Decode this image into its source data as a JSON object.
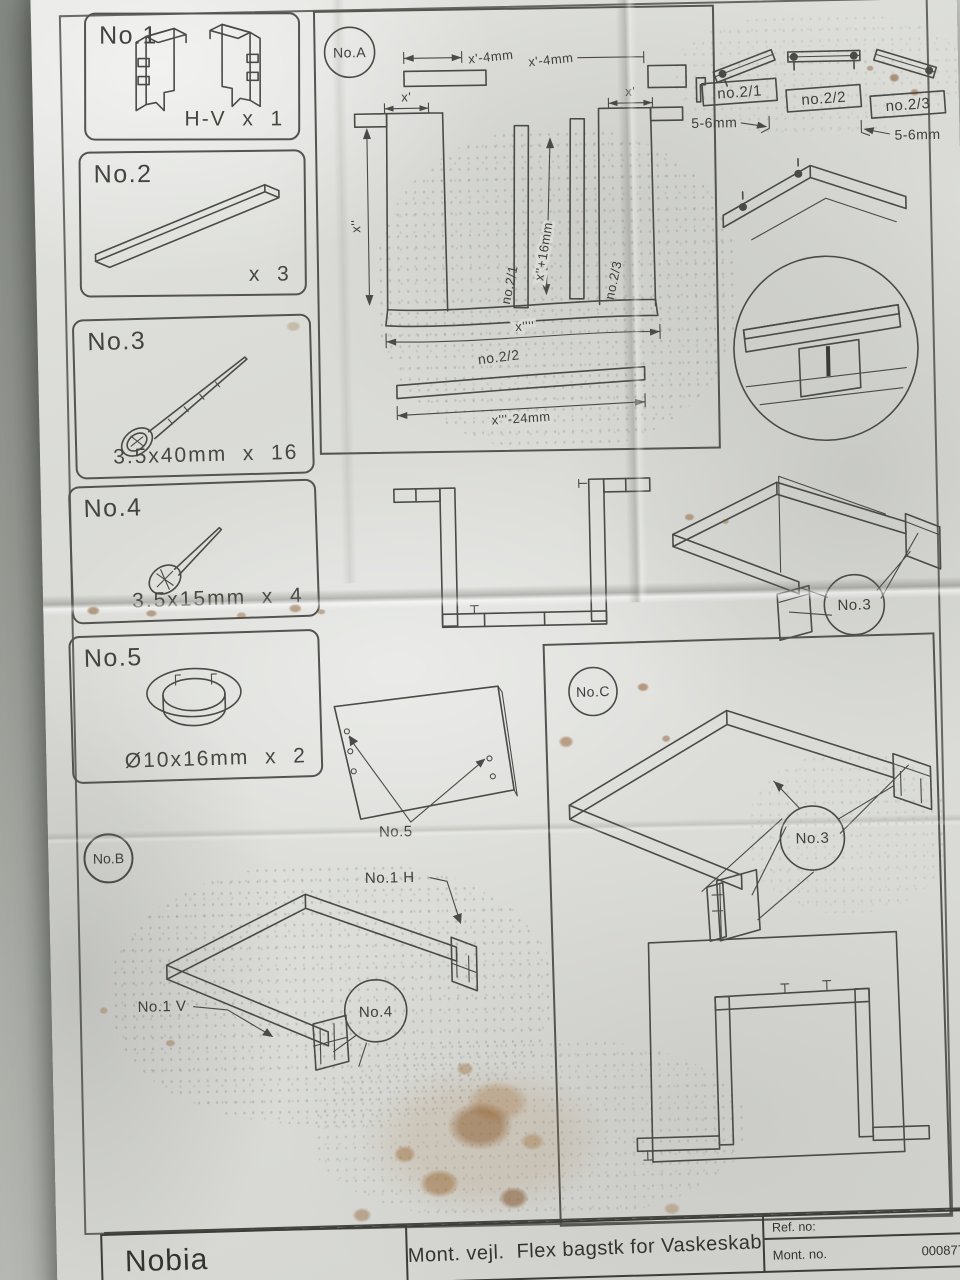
{
  "footer": {
    "brand": "Nobia",
    "title": "Mont. vejl.  Flex bagstk for Vaskeskab",
    "ref_label": "Ref. no:",
    "mont_label": "Mont. no.",
    "mont_value": "000877"
  },
  "parts": [
    {
      "label": "No.1",
      "qty": "H-V  x  1"
    },
    {
      "label": "No.2",
      "qty": "x  3"
    },
    {
      "label": "No.3",
      "qty": "3.5x40mm  x  16"
    },
    {
      "label": "No.4",
      "qty": "3.5x15mm  x  4"
    },
    {
      "label": "No.5",
      "qty": "Ø10x16mm  x  2"
    }
  ],
  "sectionA": {
    "label": "No.A",
    "dim_top_left": "x'-4mm",
    "dim_top_right": "x'-4mm",
    "dim_x_left": "x'",
    "dim_x_right": "x'",
    "dim_height": "x''",
    "strip_left": "no.2/1",
    "strip_right": "no.2/3",
    "dim_center": "x''+16mm",
    "dim_total": "x''''",
    "bar_label": "no.2/2",
    "dim_bar": "x'''-24mm"
  },
  "rails": {
    "label_1": "no.2/1",
    "label_2": "no.2/2",
    "label_3": "no.2/3",
    "gap_left": "5-6mm",
    "gap_right": "5-6mm"
  },
  "midAssembly": {
    "callout": "No.3"
  },
  "sectionB": {
    "label": "No.B",
    "panel_callout": "No.5",
    "label_h": "No.1  H",
    "label_v": "No.1  V",
    "callout": "No.4"
  },
  "sectionC": {
    "label": "No.C",
    "callout": "No.3"
  }
}
